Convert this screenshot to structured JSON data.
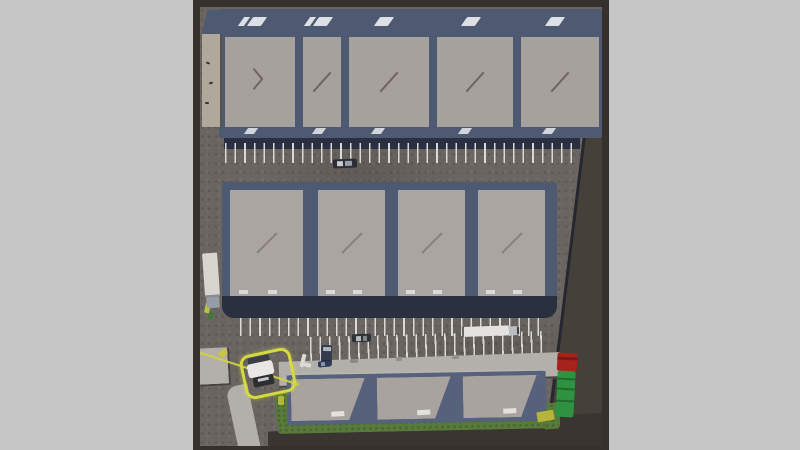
{
  "scene": {
    "description": "Top-down aerial 3D view of an industrial warehouse complex: a five-unit north warehouse with loading bays, a four-unit central warehouse, a three-unit south storage building on grass, striped truck parking rows, assorted parked vehicles, and one truck selected with a yellow highlight box and yellow route line."
  },
  "palette": {
    "bg": "#c6c6c6",
    "frame": "#37312d",
    "asphalt": "#6b6561",
    "outside": "#45403a",
    "road": "#3a3531",
    "concrete": "#b3b0ab",
    "grass": "#587a3a",
    "trim": "#4e5a71",
    "trimC": "#56617b",
    "dock": "#2b3040",
    "line": "#d9d9d8",
    "sel": "#d6da3f",
    "route": "#cfd43c",
    "tanwall": "#b1a89c"
  },
  "buildings": {
    "north": {
      "name": "north-warehouse",
      "unit_count": 5,
      "roof": "#a7a19d",
      "trim": "#4e5a71",
      "seam": "#6f655e",
      "chevron": "#e9ebee",
      "units": [
        {
          "x": 6,
          "w": 70
        },
        {
          "x": 84,
          "w": 38
        },
        {
          "x": 130,
          "w": 80
        },
        {
          "x": 218,
          "w": 76
        },
        {
          "x": 302,
          "w": 78
        }
      ]
    },
    "central": {
      "name": "central-warehouse",
      "unit_count": 4,
      "roof": "#aaa5a0",
      "trim": "#4e5a71",
      "seam": "#8a7f78",
      "dockmark": "#d9d9d9",
      "units": [
        {
          "x": 8,
          "w": 73
        },
        {
          "x": 96,
          "w": 67
        },
        {
          "x": 176,
          "w": 67
        },
        {
          "x": 256,
          "w": 67
        }
      ]
    },
    "south": {
      "name": "south-storage-building",
      "unit_count": 3,
      "roof": "#a8a39e",
      "trim": "#56617b",
      "vent": "#e4e2de",
      "units": [
        {
          "x": 4,
          "w": 74
        },
        {
          "x": 90,
          "w": 74
        },
        {
          "x": 176,
          "w": 74
        }
      ]
    }
  },
  "selection": {
    "target": "selected-truck",
    "highlight_color": "#d6da3f",
    "route_color": "#cfd43c"
  },
  "vehicles": [
    {
      "name": "pickup-truck-north-lot",
      "x": 133,
      "y": 152,
      "w": 24,
      "h": 9,
      "angle": -2,
      "parts": [
        {
          "x": 0,
          "y": 0,
          "w": 24,
          "h": 9,
          "c": "#2b2e34",
          "r": 2
        },
        {
          "x": 4,
          "y": 2,
          "w": 6,
          "h": 5,
          "c": "#c9ccd0"
        },
        {
          "x": 12,
          "y": 2,
          "w": 7,
          "h": 5,
          "c": "#9aa0a6"
        }
      ]
    },
    {
      "name": "semi-trailer-parked-west",
      "x": 3,
      "y": 246,
      "w": 17,
      "h": 56,
      "angle": -4,
      "parts": [
        {
          "x": 1,
          "y": 0,
          "w": 15,
          "h": 42,
          "c": "#d8d5cf",
          "r": 1
        },
        {
          "x": 1,
          "y": 42,
          "w": 15,
          "h": 2,
          "c": "#8a8c90"
        },
        {
          "x": 2,
          "y": 44,
          "w": 13,
          "h": 11,
          "c": "#969da6",
          "r": 1
        }
      ]
    },
    {
      "name": "box-truck-lower-lot",
      "x": 262,
      "y": 318,
      "w": 57,
      "h": 12,
      "angle": -2,
      "parts": [
        {
          "x": 0,
          "y": 1,
          "w": 2,
          "h": 10,
          "c": "#606266"
        },
        {
          "x": 2,
          "y": 1,
          "w": 45,
          "h": 10,
          "c": "#e4e2de",
          "r": 1
        },
        {
          "x": 47,
          "y": 2,
          "w": 9,
          "h": 9,
          "c": "#b9bec4",
          "r": 1
        },
        {
          "x": 55,
          "y": 3,
          "w": 2,
          "h": 7,
          "c": "#3c4043"
        }
      ]
    },
    {
      "name": "car-lower-lot",
      "x": 152,
      "y": 327,
      "w": 19,
      "h": 8,
      "angle": -2,
      "parts": [
        {
          "x": 0,
          "y": 0,
          "w": 19,
          "h": 8,
          "c": "#2e3136",
          "r": 2
        },
        {
          "x": 4,
          "y": 1.5,
          "w": 5,
          "h": 5,
          "c": "#b9bcc0"
        },
        {
          "x": 11,
          "y": 1.5,
          "w": 4,
          "h": 5,
          "c": "#84878c"
        }
      ]
    },
    {
      "name": "van-parked-lower-lot",
      "x": 121,
      "y": 338,
      "w": 11,
      "h": 21,
      "angle": 1,
      "parts": [
        {
          "x": 0,
          "y": 0,
          "w": 11,
          "h": 21,
          "c": "#353b4e",
          "r": 2
        },
        {
          "x": 1.5,
          "y": 2,
          "w": 8,
          "h": 4,
          "c": "#b0b4ba"
        },
        {
          "x": 1.5,
          "y": 15,
          "w": 8,
          "h": 3,
          "c": "#23262e"
        }
      ]
    },
    {
      "name": "car-on-apron",
      "x": 118,
      "y": 354,
      "w": 13,
      "h": 6,
      "angle": -5,
      "parts": [
        {
          "x": 0,
          "y": 0,
          "w": 13,
          "h": 6,
          "c": "#2f3a57",
          "r": 2
        },
        {
          "x": 3,
          "y": 1,
          "w": 4,
          "h": 4,
          "c": "#8b93a8"
        }
      ]
    },
    {
      "name": "selected-truck",
      "x": 48,
      "y": 348,
      "w": 27,
      "h": 32,
      "angle": -12,
      "selected": true,
      "parts": [
        {
          "x": 2,
          "y": 1,
          "w": 22,
          "h": 7,
          "c": "#3a3f46",
          "r": 2
        },
        {
          "x": 0,
          "y": 7,
          "w": 26,
          "h": 14,
          "c": "#e9e7e3",
          "r": 3
        },
        {
          "x": 3,
          "y": 21,
          "w": 21,
          "h": 10,
          "c": "#2c2e33",
          "r": 2
        },
        {
          "x": 8,
          "y": 23,
          "w": 11,
          "h": 3,
          "c": "#c8c8c6"
        }
      ]
    },
    {
      "name": "service-truck-red-green",
      "x": 355,
      "y": 345,
      "w": 22,
      "h": 66,
      "angle": 3,
      "parts": [
        {
          "x": 1,
          "y": 1,
          "w": 20,
          "h": 18,
          "c": "#a6231d",
          "r": 2
        },
        {
          "x": 1,
          "y": 5,
          "w": 20,
          "h": 3,
          "c": "#7c1713"
        },
        {
          "x": 2,
          "y": 19,
          "w": 18,
          "h": 46,
          "c": "#2f9240",
          "r": 2
        },
        {
          "x": 2,
          "y": 26,
          "w": 18,
          "h": 2,
          "c": "#1f6b2d"
        },
        {
          "x": 2,
          "y": 36,
          "w": 18,
          "h": 2,
          "c": "#1f6b2d"
        },
        {
          "x": 2,
          "y": 48,
          "w": 18,
          "h": 2,
          "c": "#1f6b2d"
        }
      ]
    }
  ],
  "props": [
    {
      "name": "pallet-yellow",
      "x": 5,
      "y": 296,
      "w": 5,
      "h": 10,
      "c": "#bfc23d",
      "angle": 12
    },
    {
      "name": "pallet-green",
      "x": 9,
      "y": 305,
      "w": 4,
      "h": 8,
      "c": "#3f7a3c",
      "angle": 12
    },
    {
      "name": "curb-yellow-mark",
      "x": 19,
      "y": 343,
      "w": 8,
      "h": 6,
      "c": "#c9c53e",
      "angle": -40
    },
    {
      "name": "grass-yellow-mark-right",
      "x": 337,
      "y": 404,
      "w": 17,
      "h": 10,
      "c": "#b5b53b",
      "angle": -10
    },
    {
      "name": "grass-yellow-mark-left",
      "x": 78,
      "y": 389,
      "w": 6,
      "h": 9,
      "c": "#b5b53b",
      "angle": 0
    },
    {
      "name": "apron-object-1",
      "x": 150,
      "y": 352,
      "w": 8,
      "h": 4,
      "c": "#8e8b86",
      "angle": -2
    },
    {
      "name": "apron-object-2",
      "x": 196,
      "y": 350,
      "w": 6,
      "h": 4,
      "c": "#93908b",
      "angle": -2
    },
    {
      "name": "apron-object-3",
      "x": 252,
      "y": 348,
      "w": 7,
      "h": 4,
      "c": "#93908b",
      "angle": -2
    },
    {
      "name": "cart-object-a",
      "x": 101,
      "y": 347,
      "w": 4,
      "h": 13,
      "c": "#dedcd7",
      "angle": 14
    },
    {
      "name": "cart-object-b",
      "x": 104,
      "y": 356,
      "w": 7,
      "h": 4,
      "c": "#dedcd7",
      "angle": 14
    },
    {
      "name": "debris-1",
      "x": 6,
      "y": 55,
      "w": 4,
      "h": 2,
      "c": "#3a3632",
      "angle": 20
    },
    {
      "name": "debris-2",
      "x": 9,
      "y": 75,
      "w": 4,
      "h": 2,
      "c": "#3a3632",
      "angle": -15
    },
    {
      "name": "debris-3",
      "x": 5,
      "y": 95,
      "w": 4,
      "h": 2,
      "c": "#3a3632",
      "angle": 0
    }
  ]
}
